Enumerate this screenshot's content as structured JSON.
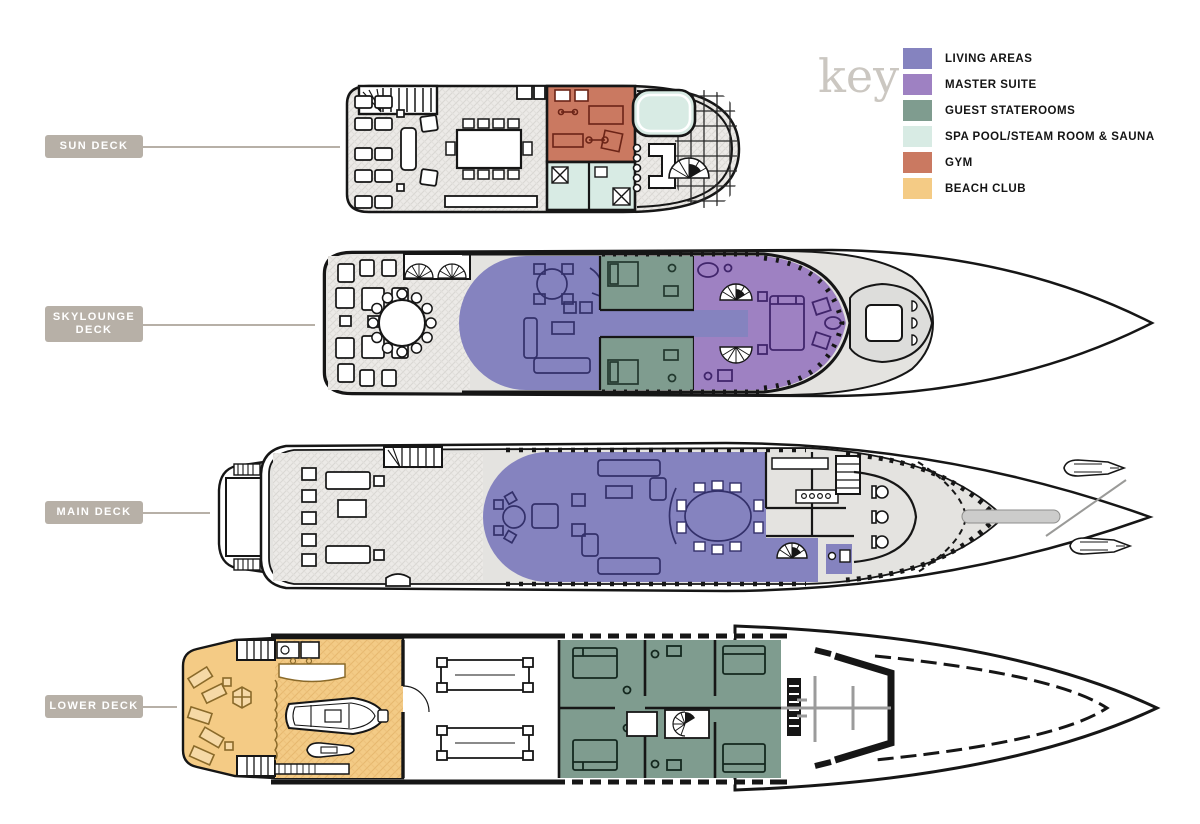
{
  "key": {
    "title": "key",
    "items": [
      {
        "id": "living-areas",
        "label": "LIVING AREAS",
        "color": "#8583bf"
      },
      {
        "id": "master-suite",
        "label": "MASTER SUITE",
        "color": "#9e81c2"
      },
      {
        "id": "guest-staterooms",
        "label": "GUEST STATEROOMS",
        "color": "#7f9c8f"
      },
      {
        "id": "spa",
        "label": "SPA POOL/STEAM ROOM & SAUNA",
        "color": "#d8ebe4"
      },
      {
        "id": "gym",
        "label": "GYM",
        "color": "#ca7961"
      },
      {
        "id": "beach-club",
        "label": "BEACH CLUB",
        "color": "#f4cb85"
      }
    ]
  },
  "decks": [
    {
      "id": "sun-deck",
      "label": "SUN DECK"
    },
    {
      "id": "skylounge-deck",
      "label": "SKYLOUNGE DECK"
    },
    {
      "id": "main-deck",
      "label": "MAIN DECK"
    },
    {
      "id": "lower-deck",
      "label": "LOWER DECK"
    }
  ],
  "colors": {
    "label_bg": "#b7b0a7",
    "connector": "#b7b0a7",
    "key_title": "#cbc7c1",
    "hull_outline": "#161616",
    "deck_fill": "#ecebe8"
  }
}
